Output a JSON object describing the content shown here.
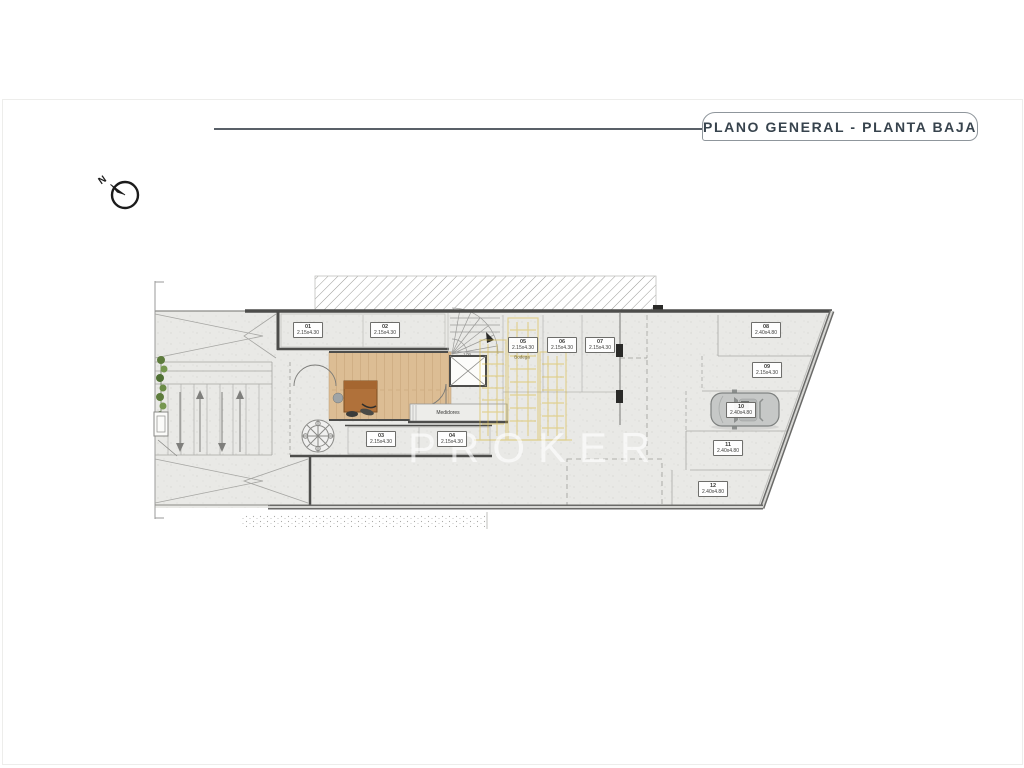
{
  "header": {
    "title": "PLANO GENERAL - PLANTA BAJA",
    "compass_label": "N"
  },
  "watermark": {
    "brand": "PROKER"
  },
  "plan": {
    "texts": {
      "medidores": "Medidores",
      "bodega": "Bodega",
      "stair_dim": "1.00"
    },
    "parking": [
      {
        "id": "01",
        "dim": "2.15x4.30"
      },
      {
        "id": "02",
        "dim": "2.15x4.30"
      },
      {
        "id": "03",
        "dim": "2.15x4.30"
      },
      {
        "id": "04",
        "dim": "2.15x4.30"
      },
      {
        "id": "05",
        "dim": "2.15x4.30"
      },
      {
        "id": "06",
        "dim": "2.15x4.30"
      },
      {
        "id": "07",
        "dim": "2.15x4.30"
      },
      {
        "id": "08",
        "dim": "2.40x4.80"
      },
      {
        "id": "09",
        "dim": "2.15x4.30"
      },
      {
        "id": "10",
        "dim": "2.40x4.80"
      },
      {
        "id": "11",
        "dim": "2.40x4.80"
      },
      {
        "id": "12",
        "dim": "2.40x4.80"
      }
    ],
    "colors": {
      "wall": "#4d4d4b",
      "floor": "#e9e9e6",
      "wood": "#dcbd94",
      "accent_gold": "#d8b83e",
      "plant_green": "#5d7c3c",
      "title_text": "#37434d"
    }
  }
}
